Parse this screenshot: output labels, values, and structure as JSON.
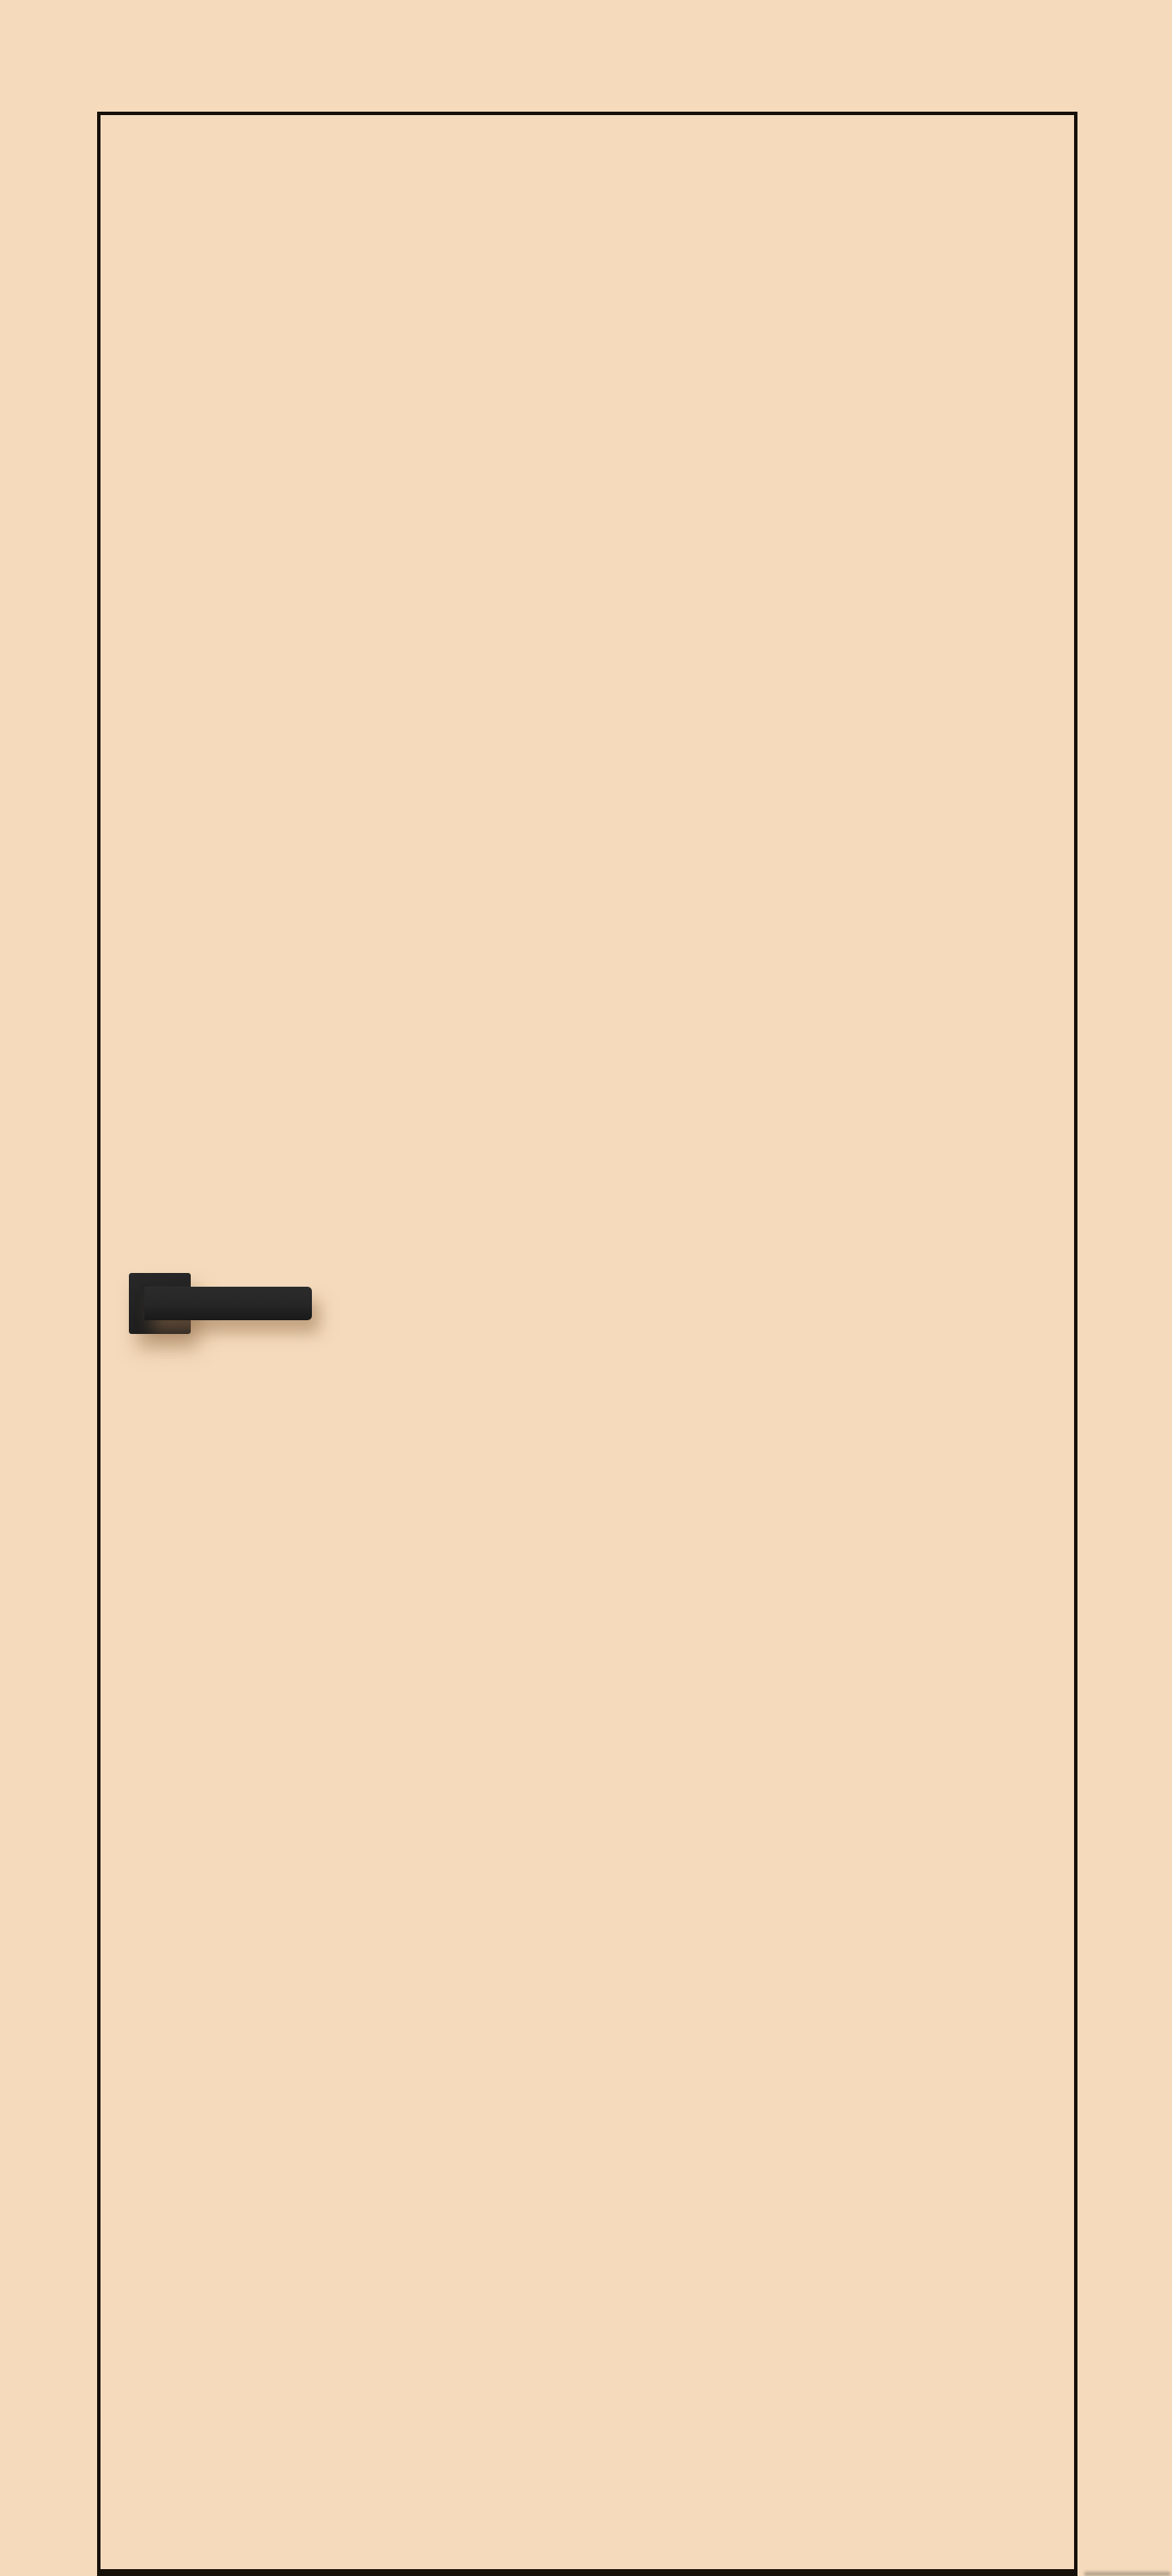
{
  "image": {
    "type": "product-render",
    "subject": "Flat slab interior door in beige finish with black edge trim and a matte black square-rose lever handle",
    "visible_text": []
  },
  "colors": {
    "background": "#f5dbbc",
    "door-fill": "#f5dbbc",
    "door-outline": "#171009",
    "plate-top": "#282828",
    "plate-bottom": "#1c1c1c",
    "handle-top": "#2c2c2c",
    "handle-bottom": "#191919",
    "handle-shadow": "rgba(146,108,72,0.50)",
    "floor-shadow": "rgba(125,115,100,0.55)"
  }
}
